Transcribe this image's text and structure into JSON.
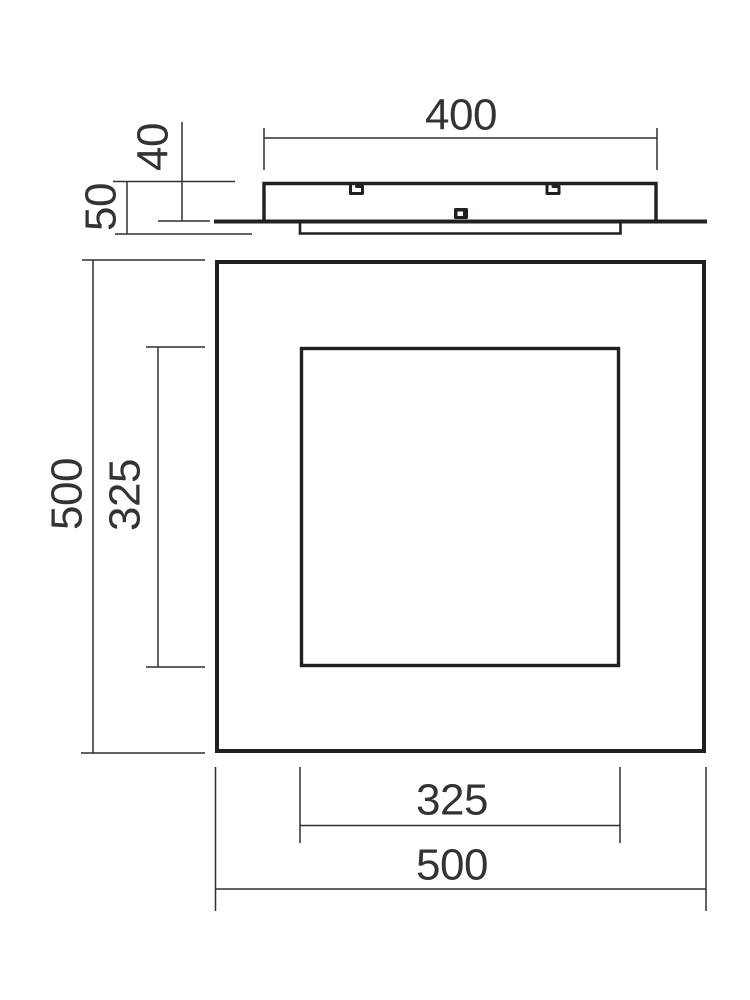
{
  "drawing": {
    "type": "technical dimension drawing of a square ceiling lamp",
    "views": {
      "side": {
        "labels": {
          "body_width": "400",
          "body_height": "40",
          "total_height": "50"
        }
      },
      "front": {
        "labels": {
          "outer_height": "500",
          "inner_height": "325",
          "inner_width": "325",
          "outer_width": "500"
        }
      }
    },
    "colors": {
      "background": "#ffffff",
      "outline": "#231f20",
      "dimension_lines": "#332f30",
      "label_text": "#363233"
    }
  }
}
